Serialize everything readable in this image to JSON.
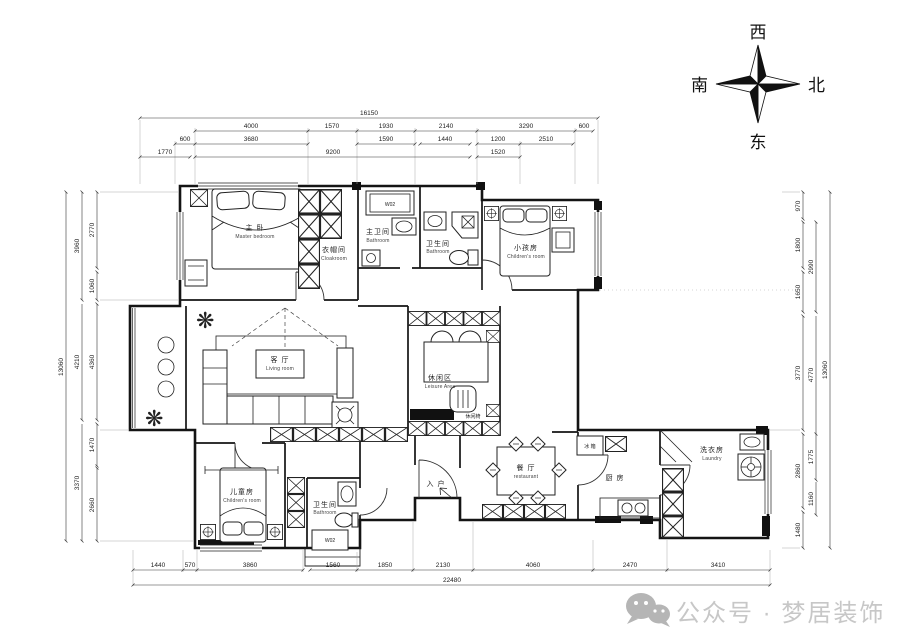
{
  "compass": {
    "west": "西",
    "north": "北",
    "south": "南",
    "east": "东"
  },
  "watermark": {
    "label": "公众号 · 梦居装饰"
  },
  "icons": {
    "plant": "❋"
  },
  "rooms": {
    "master": {
      "zh": "主 卧",
      "en": "Master bedroom"
    },
    "cloak": {
      "zh": "衣帽间",
      "en": "Cloakroom"
    },
    "master_bath": {
      "zh": "主卫间",
      "en": "Bathroom"
    },
    "bath_top": {
      "zh": "卫生间",
      "en": "Bathroom"
    },
    "kids_top": {
      "zh": "小孩房",
      "en": "Children's room"
    },
    "living": {
      "zh": "客 厅",
      "en": "Living room"
    },
    "leisure": {
      "zh": "休闲区",
      "en": "Leisure Area"
    },
    "leisure_note": "休闲椅",
    "kids_bottom": {
      "zh": "儿童房",
      "en": "Children's room"
    },
    "bath_bottom": {
      "zh": "卫生间",
      "en": "Bathroom"
    },
    "dining": {
      "zh": "餐 厅",
      "en": "restaurant"
    },
    "kitchen": {
      "zh": "厨 房"
    },
    "laundry": {
      "zh": "洗衣房",
      "en": "Laundry"
    },
    "entry": "入 户",
    "fridge": "冰 箱",
    "heater_top": "W02",
    "heater_bottom": "W02"
  },
  "dims": {
    "top": {
      "total": "16150",
      "tier2": [
        "4000",
        "1570",
        "1930",
        "2140",
        "3290",
        "600"
      ],
      "tier3": [
        "600",
        "3680",
        "1590",
        "1440",
        "1200",
        "2510"
      ],
      "tier4": [
        "1770",
        "9200",
        "1520"
      ]
    },
    "bottom": {
      "total": "22480",
      "tier1": [
        "1440",
        "570",
        "3860",
        "1560",
        "1850",
        "2130",
        "4060",
        "2470",
        "3410"
      ]
    },
    "left": {
      "total": "13060",
      "mid": [
        "3960",
        "4210",
        "3370"
      ],
      "inner": [
        "2770",
        "1060",
        "4360",
        "1470",
        "2660"
      ]
    },
    "right": {
      "total": "13060",
      "inner": [
        "970",
        "1800",
        "1650",
        "3770",
        "2860",
        "1480"
      ],
      "mid": [
        "2990",
        "4770",
        "1775",
        "1160"
      ]
    }
  }
}
